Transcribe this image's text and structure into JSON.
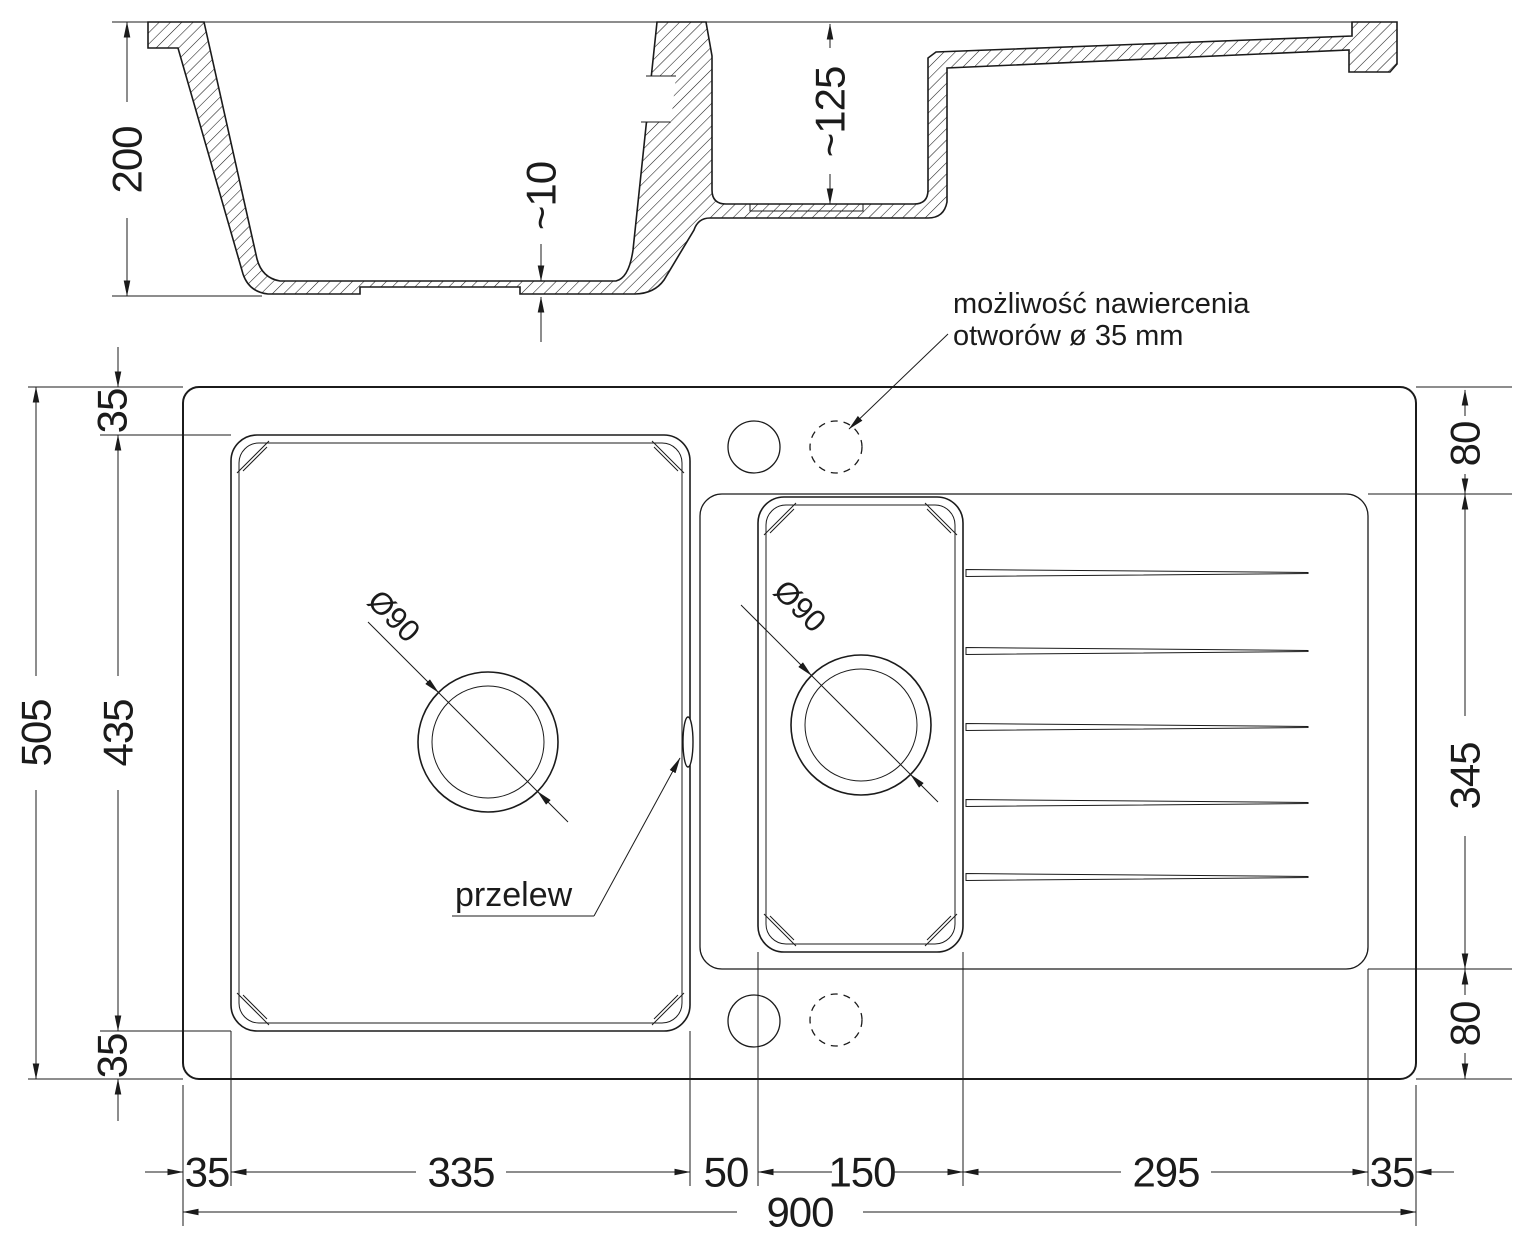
{
  "section": {
    "dim_depth_main": "200",
    "dim_bottom_thickness": "~10",
    "dim_depth_half": "~125"
  },
  "plan": {
    "dim_left_margin_top": "35",
    "dim_left_bowl": "435",
    "dim_left_total": "505",
    "dim_left_margin_bottom": "35",
    "dim_right_top": "80",
    "dim_right_drainer": "345",
    "dim_right_bottom": "80",
    "dim_bottom_1": "35",
    "dim_bottom_2": "335",
    "dim_bottom_3": "50",
    "dim_bottom_4": "150",
    "dim_bottom_5": "295",
    "dim_bottom_6": "35",
    "dim_bottom_total": "900",
    "drain_main_diameter": "Ø90",
    "drain_half_diameter": "Ø90",
    "overflow_label": "przelew",
    "note_line1": "możliwość nawiercenia",
    "note_line2": "otworów ø 35 mm"
  },
  "colors": {
    "line": "#1b1b1b",
    "background": "#ffffff"
  }
}
